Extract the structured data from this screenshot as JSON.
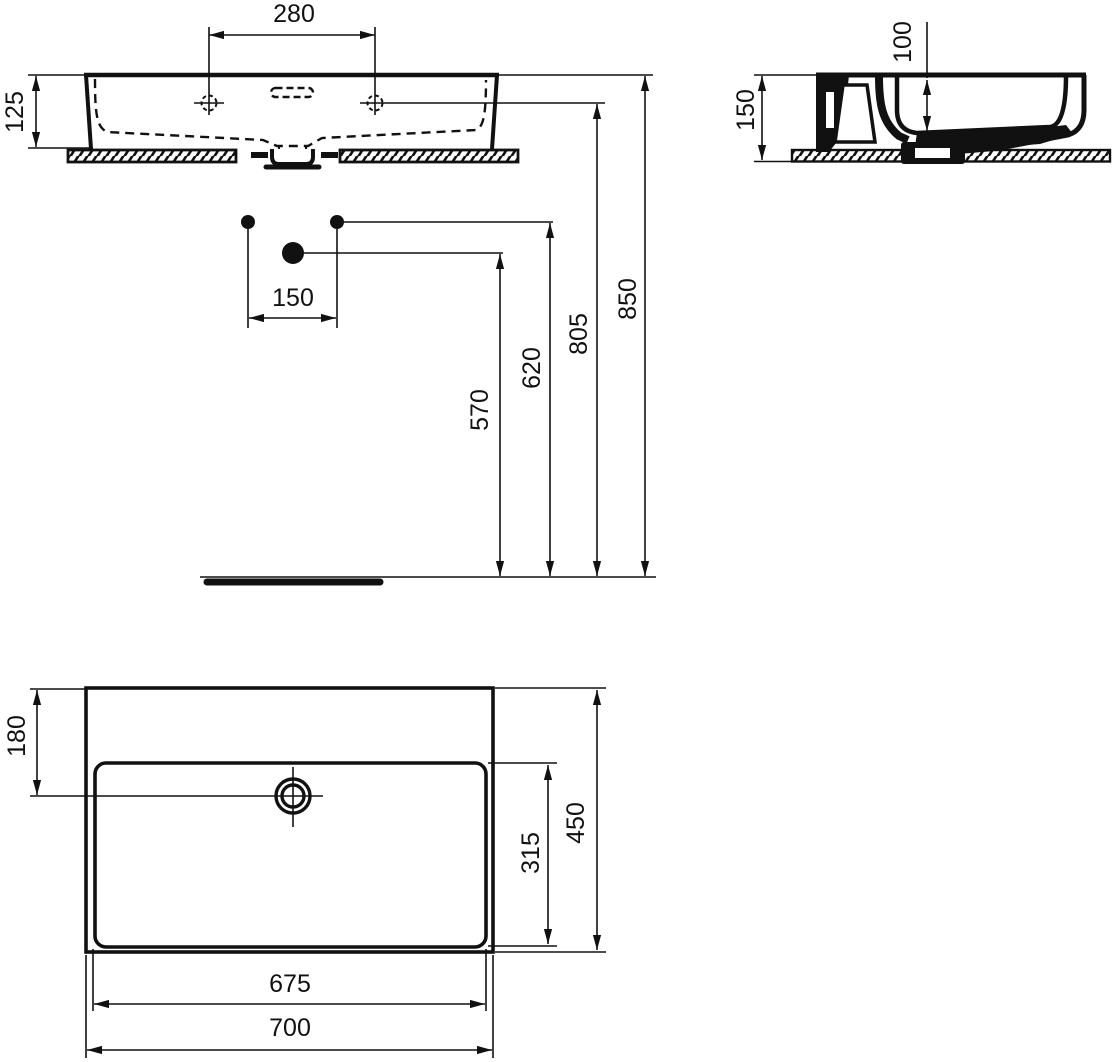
{
  "views": {
    "front": {
      "tap_hole_spacing": "280",
      "basin_height": "125"
    },
    "side": {
      "mounting_height": "150",
      "bowl_depth": "100"
    },
    "installation": {
      "supply_spacing": "150",
      "drain_height": "570",
      "supply_height": "620",
      "tap_level_height": "805",
      "rim_height": "850"
    },
    "plan": {
      "drain_center_from_back": "180",
      "overall_depth": "450",
      "bowl_inner_depth": "315",
      "bowl_inner_width": "675",
      "overall_width": "700"
    }
  }
}
